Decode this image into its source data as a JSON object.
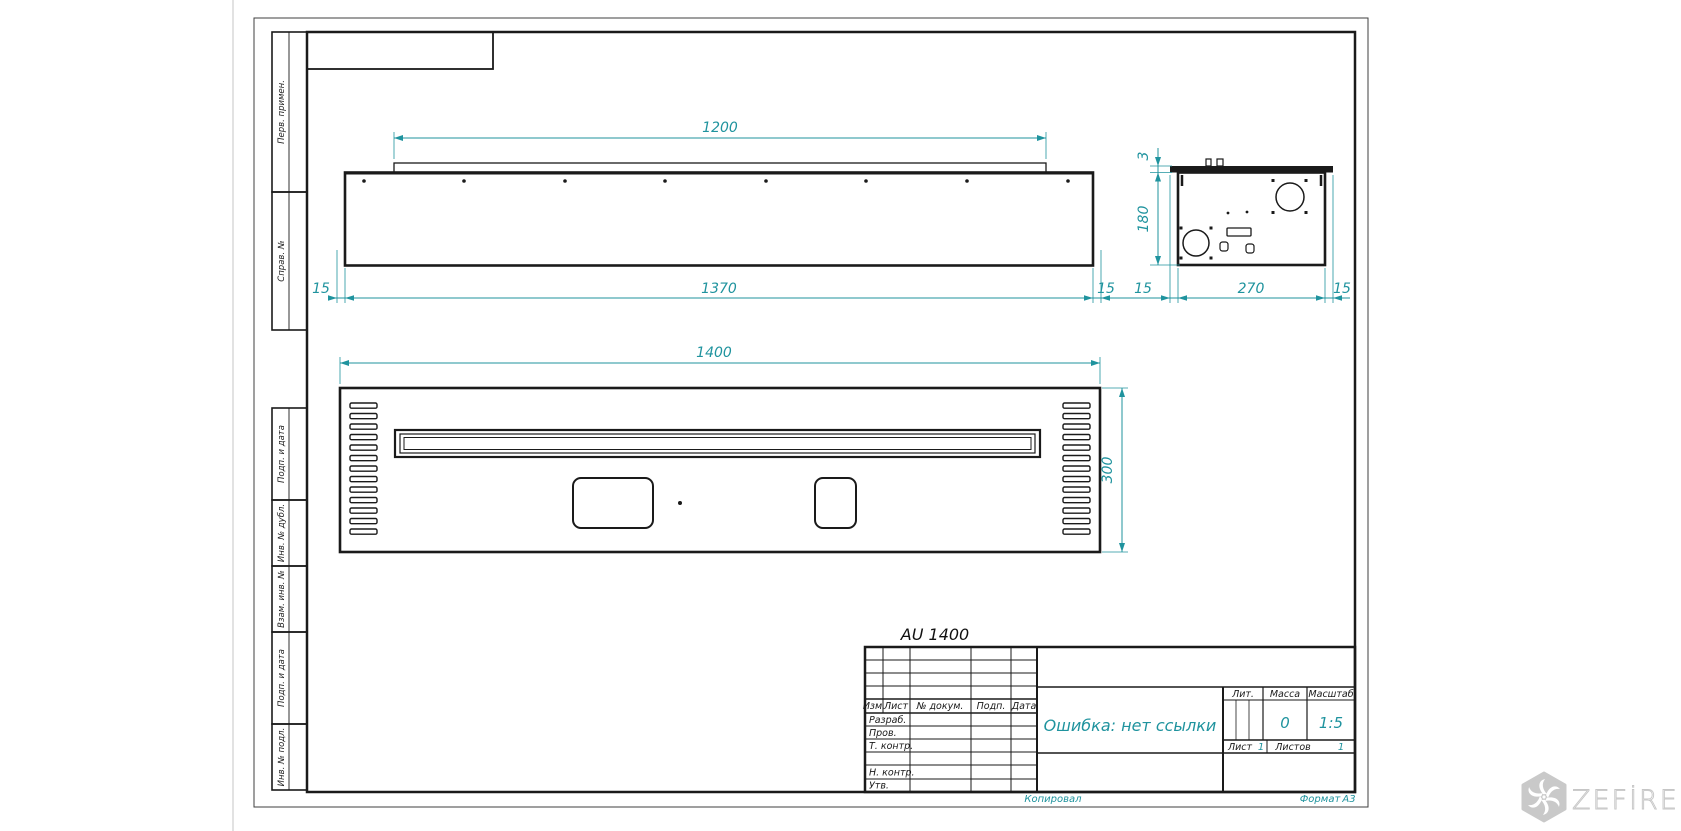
{
  "sheet": {
    "designation": "AU 1400",
    "copied_by": "Копировал",
    "format_label": "Формат",
    "format_value": "A3",
    "margin_stamps": {
      "perv": "Перв. примен.",
      "sprav": "Справ. №",
      "podp1": "Подп. и дата",
      "inv_dubl": "Инв. № дубл.",
      "vzam": "Взам. инв. №",
      "podp2": "Подп. и дата",
      "inv_podl": "Инв. № подл."
    }
  },
  "title_block": {
    "col_izm": "Изм.",
    "col_list": "Лист",
    "col_doc": "№ докум.",
    "col_podp": "Подп.",
    "col_data": "Дата",
    "row_razrab": "Разраб.",
    "row_prov": "Пров.",
    "row_tkontr": "Т. контр.",
    "row_nkontr": "Н. контр.",
    "row_utv": "Утв.",
    "doc_name": "Ошибка: нет ссылки",
    "lit_label": "Лит.",
    "mass_label": "Масса",
    "scale_label": "Масштаб",
    "mass_value": "0",
    "scale_value": "1:5",
    "sheet_label": "Лист",
    "sheet_value": "1",
    "sheets_label": "Листов",
    "sheets_value": "1"
  },
  "dimensions": {
    "burner_opening": "1200",
    "margin_left": "15",
    "body_width": "1370",
    "margin_right": "15",
    "plate_thickness": "3",
    "body_height": "180",
    "side_margin_left": "15",
    "side_width": "270",
    "side_margin_right": "15",
    "plan_width": "1400",
    "plan_depth": "300"
  },
  "watermark": {
    "brand": "ZEFİRE"
  },
  "colors": {
    "dim_color": "#1f939e",
    "line_color": "#1a1a1a",
    "watermark_color": "#c9c9c9"
  }
}
